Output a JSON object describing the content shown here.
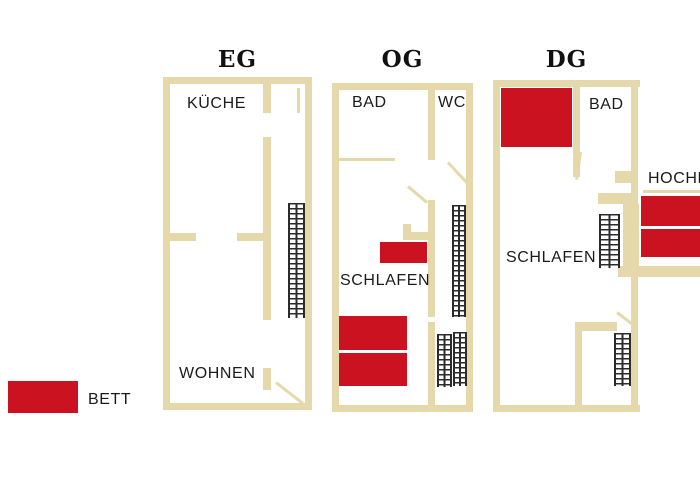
{
  "colors": {
    "wall": "#e5d9ac",
    "bed": "#cb1220",
    "text": "#1b1b1b",
    "stairline": "#2b2b2b",
    "background": "#ffffff"
  },
  "floors": [
    {
      "id": "eg",
      "title": "EG",
      "rooms": {
        "kueche": "KÜCHE",
        "wohnen": "WOHNEN"
      }
    },
    {
      "id": "og",
      "title": "OG",
      "rooms": {
        "bad": "BAD",
        "wc": "WC",
        "schlafen": "SCHLAFEN"
      }
    },
    {
      "id": "dg",
      "title": "DG",
      "rooms": {
        "bad": "BAD",
        "schlafen": "SCHLAFEN",
        "hochbett": "HOCHBETT"
      }
    }
  ],
  "legend": {
    "label": "BETT"
  }
}
